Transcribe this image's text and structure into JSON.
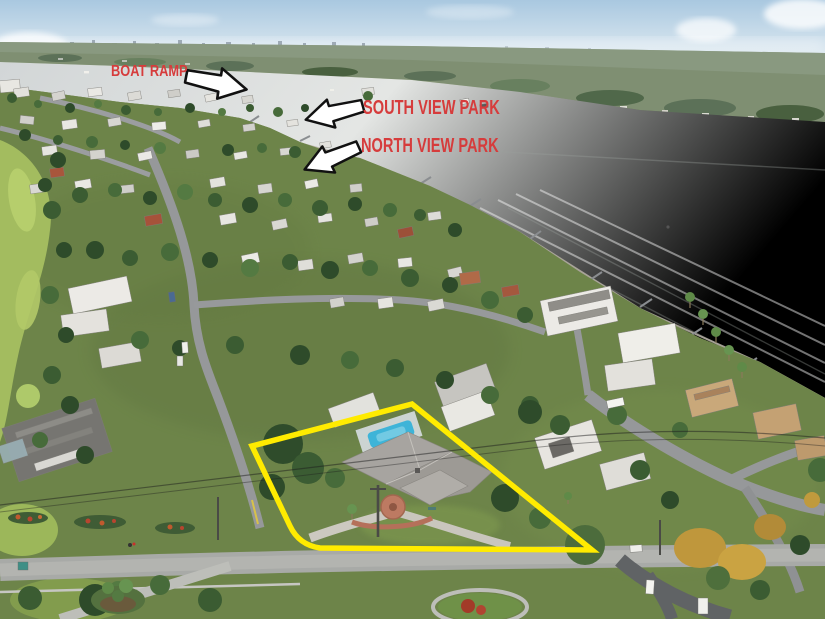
{
  "annotations": {
    "labels": [
      {
        "id": "boat-ramp",
        "text": "BOAT RAMP",
        "arrow_direction": "right"
      },
      {
        "id": "south-view-park",
        "text": "SOUTH VIEW PARK",
        "arrow_direction": "left"
      },
      {
        "id": "north-view-park",
        "text": "NORTH VIEW PARK",
        "arrow_direction": "left"
      }
    ],
    "property_outline": {
      "color": "#ffeb00"
    }
  },
  "colors": {
    "label-red": "#d63c3c",
    "outline-yellow": "#ffeb00",
    "arrow-fill": "#ffffff",
    "arrow-stroke": "#111111",
    "pool-blue": "#3eb4d8"
  }
}
